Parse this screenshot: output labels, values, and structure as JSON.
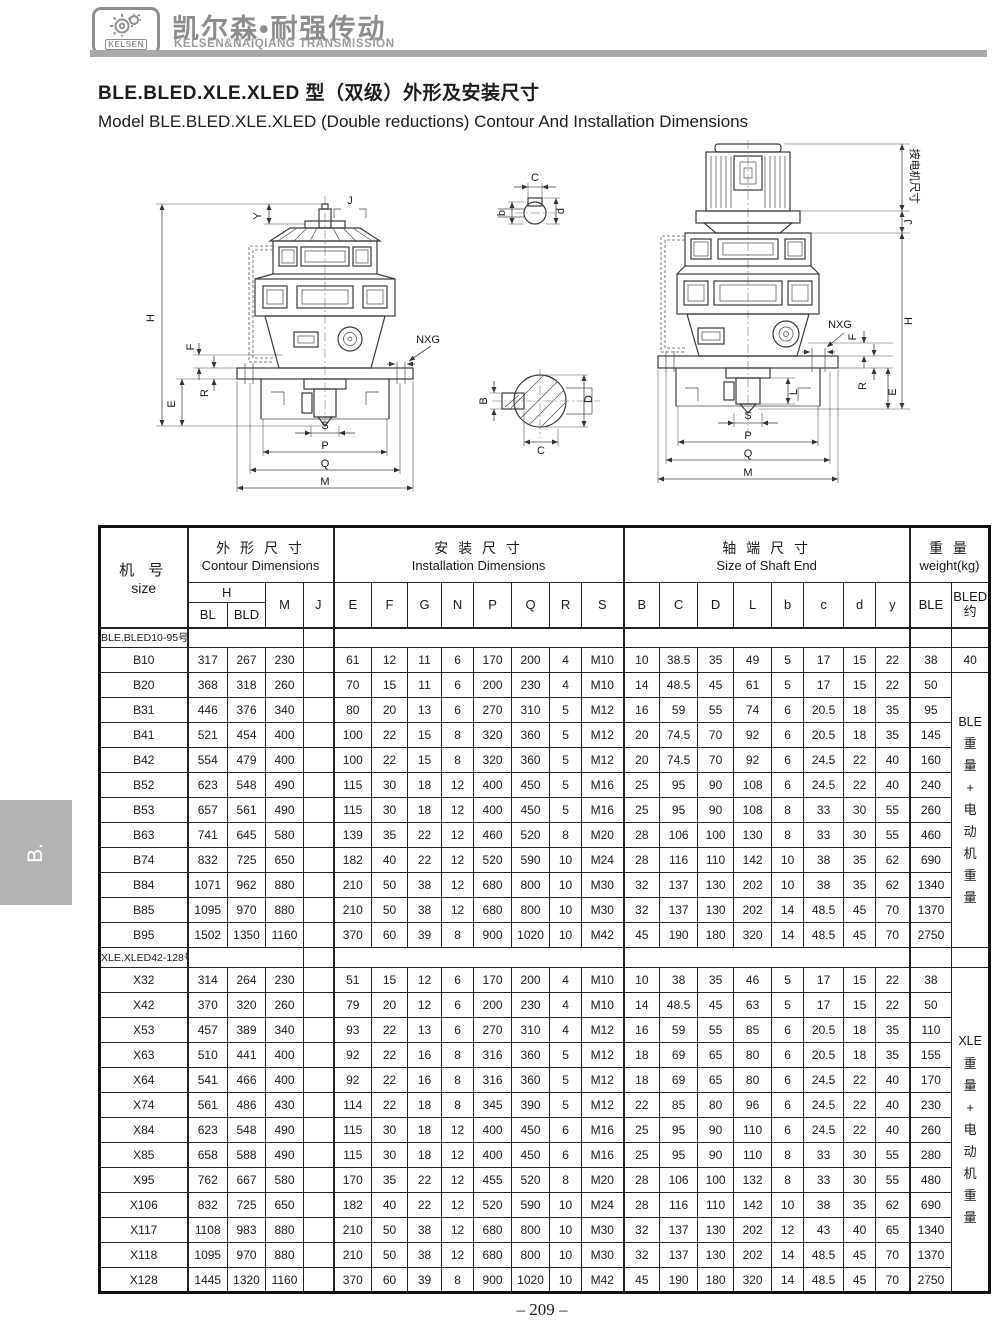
{
  "brand": {
    "logo_text": "KELSEN",
    "name_cn": "凯尔森•耐强传动",
    "name_en": "KELSEN&NAIQIANG TRANSMISSION"
  },
  "titles": {
    "cn": "BLE.BLED.XLE.XLED 型（双级）外形及安装尺寸",
    "en": "Model BLE.BLED.XLE.XLED (Double reductions) Contour And Installation Dimensions"
  },
  "side_tab": "B.",
  "page_number": "– 209 –",
  "colors": {
    "brand_gray": "#8c8c8c",
    "bar_gray": "#a9a9a9",
    "tab_gray": "#b4b4b4"
  },
  "diagram": {
    "left": {
      "Y": "Y",
      "J": "J",
      "H": "H",
      "F": "F",
      "R": "R",
      "E": "E",
      "NXG": "NXG",
      "S": "S",
      "P": "P",
      "Q": "Q",
      "M": "M"
    },
    "detail_top": {
      "C": "C",
      "b": "b",
      "d": "d"
    },
    "detail_bottom": {
      "B": "B",
      "C": "C",
      "D": "D"
    },
    "right": {
      "motor_note": "按电机尺寸",
      "J": "J",
      "H": "H",
      "NXG": "NXG",
      "F": "F",
      "R": "R",
      "E": "E",
      "L": "L",
      "S": "S",
      "P": "P",
      "Q": "Q",
      "M": "M"
    }
  },
  "table": {
    "headers": {
      "size_cn": "机 号",
      "size_en": "size",
      "contour_cn": "外 形 尺 寸",
      "contour_en": "Contour Dimensions",
      "install_cn": "安 装 尺 寸",
      "install_en": "Installation Dimensions",
      "shaft_cn": "轴 端 尺 寸",
      "shaft_en": "Size of Shaft End",
      "weight_cn": "重 量",
      "weight_en": "weight(kg)",
      "h_label": "H",
      "bled_line1": "BLED",
      "bled_line2": "约"
    },
    "cols": [
      "BL",
      "BLD",
      "M",
      "J",
      "E",
      "F",
      "G",
      "N",
      "P",
      "Q",
      "R",
      "S",
      "B",
      "C",
      "D",
      "L",
      "b",
      "c",
      "d",
      "y",
      "BLE"
    ],
    "groups": [
      {
        "label": "BLE.BLED10-95号",
        "weight_note": {
          "prefix": "BLE",
          "rest": "重量+电动机重量"
        },
        "rows": [
          {
            "size": "B10",
            "cells": [
              "317",
              "267",
              "230",
              "",
              "61",
              "12",
              "11",
              "6",
              "170",
              "200",
              "4",
              "M10",
              "10",
              "38.5",
              "35",
              "49",
              "5",
              "17",
              "15",
              "22",
              "38"
            ],
            "bled": "40"
          },
          {
            "size": "B20",
            "cells": [
              "368",
              "318",
              "260",
              "",
              "70",
              "15",
              "11",
              "6",
              "200",
              "230",
              "4",
              "M10",
              "14",
              "48.5",
              "45",
              "61",
              "5",
              "17",
              "15",
              "22",
              "50"
            ]
          },
          {
            "size": "B31",
            "cells": [
              "446",
              "376",
              "340",
              "",
              "80",
              "20",
              "13",
              "6",
              "270",
              "310",
              "5",
              "M12",
              "16",
              "59",
              "55",
              "74",
              "6",
              "20.5",
              "18",
              "35",
              "95"
            ]
          },
          {
            "size": "B41",
            "cells": [
              "521",
              "454",
              "400",
              "",
              "100",
              "22",
              "15",
              "8",
              "320",
              "360",
              "5",
              "M12",
              "20",
              "74.5",
              "70",
              "92",
              "6",
              "20.5",
              "18",
              "35",
              "145"
            ]
          },
          {
            "size": "B42",
            "cells": [
              "554",
              "479",
              "400",
              "",
              "100",
              "22",
              "15",
              "8",
              "320",
              "360",
              "5",
              "M12",
              "20",
              "74.5",
              "70",
              "92",
              "6",
              "24.5",
              "22",
              "40",
              "160"
            ]
          },
          {
            "size": "B52",
            "cells": [
              "623",
              "548",
              "490",
              "",
              "115",
              "30",
              "18",
              "12",
              "400",
              "450",
              "5",
              "M16",
              "25",
              "95",
              "90",
              "108",
              "6",
              "24.5",
              "22",
              "40",
              "240"
            ]
          },
          {
            "size": "B53",
            "cells": [
              "657",
              "561",
              "490",
              "",
              "115",
              "30",
              "18",
              "12",
              "400",
              "450",
              "5",
              "M16",
              "25",
              "95",
              "90",
              "108",
              "8",
              "33",
              "30",
              "55",
              "260"
            ]
          },
          {
            "size": "B63",
            "cells": [
              "741",
              "645",
              "580",
              "",
              "139",
              "35",
              "22",
              "12",
              "460",
              "520",
              "8",
              "M20",
              "28",
              "106",
              "100",
              "130",
              "8",
              "33",
              "30",
              "55",
              "460"
            ]
          },
          {
            "size": "B74",
            "cells": [
              "832",
              "725",
              "650",
              "",
              "182",
              "40",
              "22",
              "12",
              "520",
              "590",
              "10",
              "M24",
              "28",
              "116",
              "110",
              "142",
              "10",
              "38",
              "35",
              "62",
              "690"
            ]
          },
          {
            "size": "B84",
            "cells": [
              "1071",
              "962",
              "880",
              "",
              "210",
              "50",
              "38",
              "12",
              "680",
              "800",
              "10",
              "M30",
              "32",
              "137",
              "130",
              "202",
              "10",
              "38",
              "35",
              "62",
              "1340"
            ]
          },
          {
            "size": "B85",
            "cells": [
              "1095",
              "970",
              "880",
              "",
              "210",
              "50",
              "38",
              "12",
              "680",
              "800",
              "10",
              "M30",
              "32",
              "137",
              "130",
              "202",
              "14",
              "48.5",
              "45",
              "70",
              "1370"
            ]
          },
          {
            "size": "B95",
            "cells": [
              "1502",
              "1350",
              "1160",
              "",
              "370",
              "60",
              "39",
              "8",
              "900",
              "1020",
              "10",
              "M42",
              "45",
              "190",
              "180",
              "320",
              "14",
              "48.5",
              "45",
              "70",
              "2750"
            ]
          }
        ]
      },
      {
        "label": "XLE.XLED42-128号",
        "weight_note": {
          "prefix": "XLE",
          "rest": "重量+电动机重量"
        },
        "rows": [
          {
            "size": "X32",
            "cells": [
              "314",
              "264",
              "230",
              "",
              "51",
              "15",
              "12",
              "6",
              "170",
              "200",
              "4",
              "M10",
              "10",
              "38",
              "35",
              "46",
              "5",
              "17",
              "15",
              "22",
              "38"
            ]
          },
          {
            "size": "X42",
            "cells": [
              "370",
              "320",
              "260",
              "",
              "79",
              "20",
              "12",
              "6",
              "200",
              "230",
              "4",
              "M10",
              "14",
              "48.5",
              "45",
              "63",
              "5",
              "17",
              "15",
              "22",
              "50"
            ]
          },
          {
            "size": "X53",
            "cells": [
              "457",
              "389",
              "340",
              "",
              "93",
              "22",
              "13",
              "6",
              "270",
              "310",
              "4",
              "M12",
              "16",
              "59",
              "55",
              "85",
              "6",
              "20.5",
              "18",
              "35",
              "110"
            ]
          },
          {
            "size": "X63",
            "cells": [
              "510",
              "441",
              "400",
              "",
              "92",
              "22",
              "16",
              "8",
              "316",
              "360",
              "5",
              "M12",
              "18",
              "69",
              "65",
              "80",
              "6",
              "20.5",
              "18",
              "35",
              "155"
            ]
          },
          {
            "size": "X64",
            "cells": [
              "541",
              "466",
              "400",
              "",
              "92",
              "22",
              "16",
              "8",
              "316",
              "360",
              "5",
              "M12",
              "18",
              "69",
              "65",
              "80",
              "6",
              "24.5",
              "22",
              "40",
              "170"
            ]
          },
          {
            "size": "X74",
            "cells": [
              "561",
              "486",
              "430",
              "",
              "114",
              "22",
              "18",
              "8",
              "345",
              "390",
              "5",
              "M12",
              "22",
              "85",
              "80",
              "96",
              "6",
              "24.5",
              "22",
              "40",
              "230"
            ]
          },
          {
            "size": "X84",
            "cells": [
              "623",
              "548",
              "490",
              "",
              "115",
              "30",
              "18",
              "12",
              "400",
              "450",
              "6",
              "M16",
              "25",
              "95",
              "90",
              "110",
              "6",
              "24.5",
              "22",
              "40",
              "260"
            ]
          },
          {
            "size": "X85",
            "cells": [
              "658",
              "588",
              "490",
              "",
              "115",
              "30",
              "18",
              "12",
              "400",
              "450",
              "6",
              "M16",
              "25",
              "95",
              "90",
              "110",
              "8",
              "33",
              "30",
              "55",
              "280"
            ]
          },
          {
            "size": "X95",
            "cells": [
              "762",
              "667",
              "580",
              "",
              "170",
              "35",
              "22",
              "12",
              "455",
              "520",
              "8",
              "M20",
              "28",
              "106",
              "100",
              "132",
              "8",
              "33",
              "30",
              "55",
              "480"
            ]
          },
          {
            "size": "X106",
            "cells": [
              "832",
              "725",
              "650",
              "",
              "182",
              "40",
              "22",
              "12",
              "520",
              "590",
              "10",
              "M24",
              "28",
              "116",
              "110",
              "142",
              "10",
              "38",
              "35",
              "62",
              "690"
            ]
          },
          {
            "size": "X117",
            "cells": [
              "1108",
              "983",
              "880",
              "",
              "210",
              "50",
              "38",
              "12",
              "680",
              "800",
              "10",
              "M30",
              "32",
              "137",
              "130",
              "202",
              "12",
              "43",
              "40",
              "65",
              "1340"
            ]
          },
          {
            "size": "X118",
            "cells": [
              "1095",
              "970",
              "880",
              "",
              "210",
              "50",
              "38",
              "12",
              "680",
              "800",
              "10",
              "M30",
              "32",
              "137",
              "130",
              "202",
              "14",
              "48.5",
              "45",
              "70",
              "1370"
            ]
          },
          {
            "size": "X128",
            "cells": [
              "1445",
              "1320",
              "1160",
              "",
              "370",
              "60",
              "39",
              "8",
              "900",
              "1020",
              "10",
              "M42",
              "45",
              "190",
              "180",
              "320",
              "14",
              "48.5",
              "45",
              "70",
              "2750"
            ]
          }
        ]
      }
    ]
  }
}
